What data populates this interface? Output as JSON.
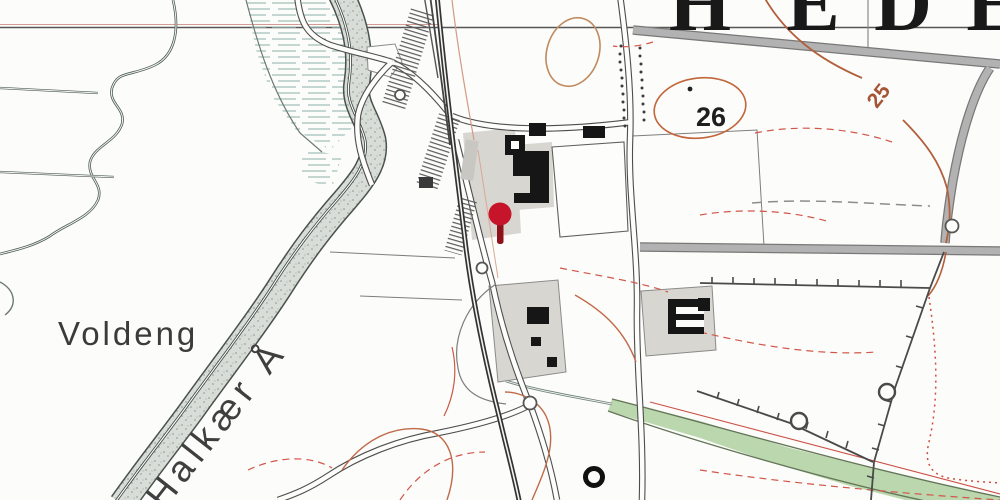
{
  "map": {
    "title_letters": {
      "l1": "H",
      "l2": "E",
      "l3": "D",
      "l4": "E"
    },
    "labels": {
      "area": "Voldeng",
      "river": "Halkær Å",
      "elevation_26": "26",
      "contour_25": "25"
    },
    "marker": {
      "type": "map-pin",
      "color": "#c6152b"
    }
  }
}
